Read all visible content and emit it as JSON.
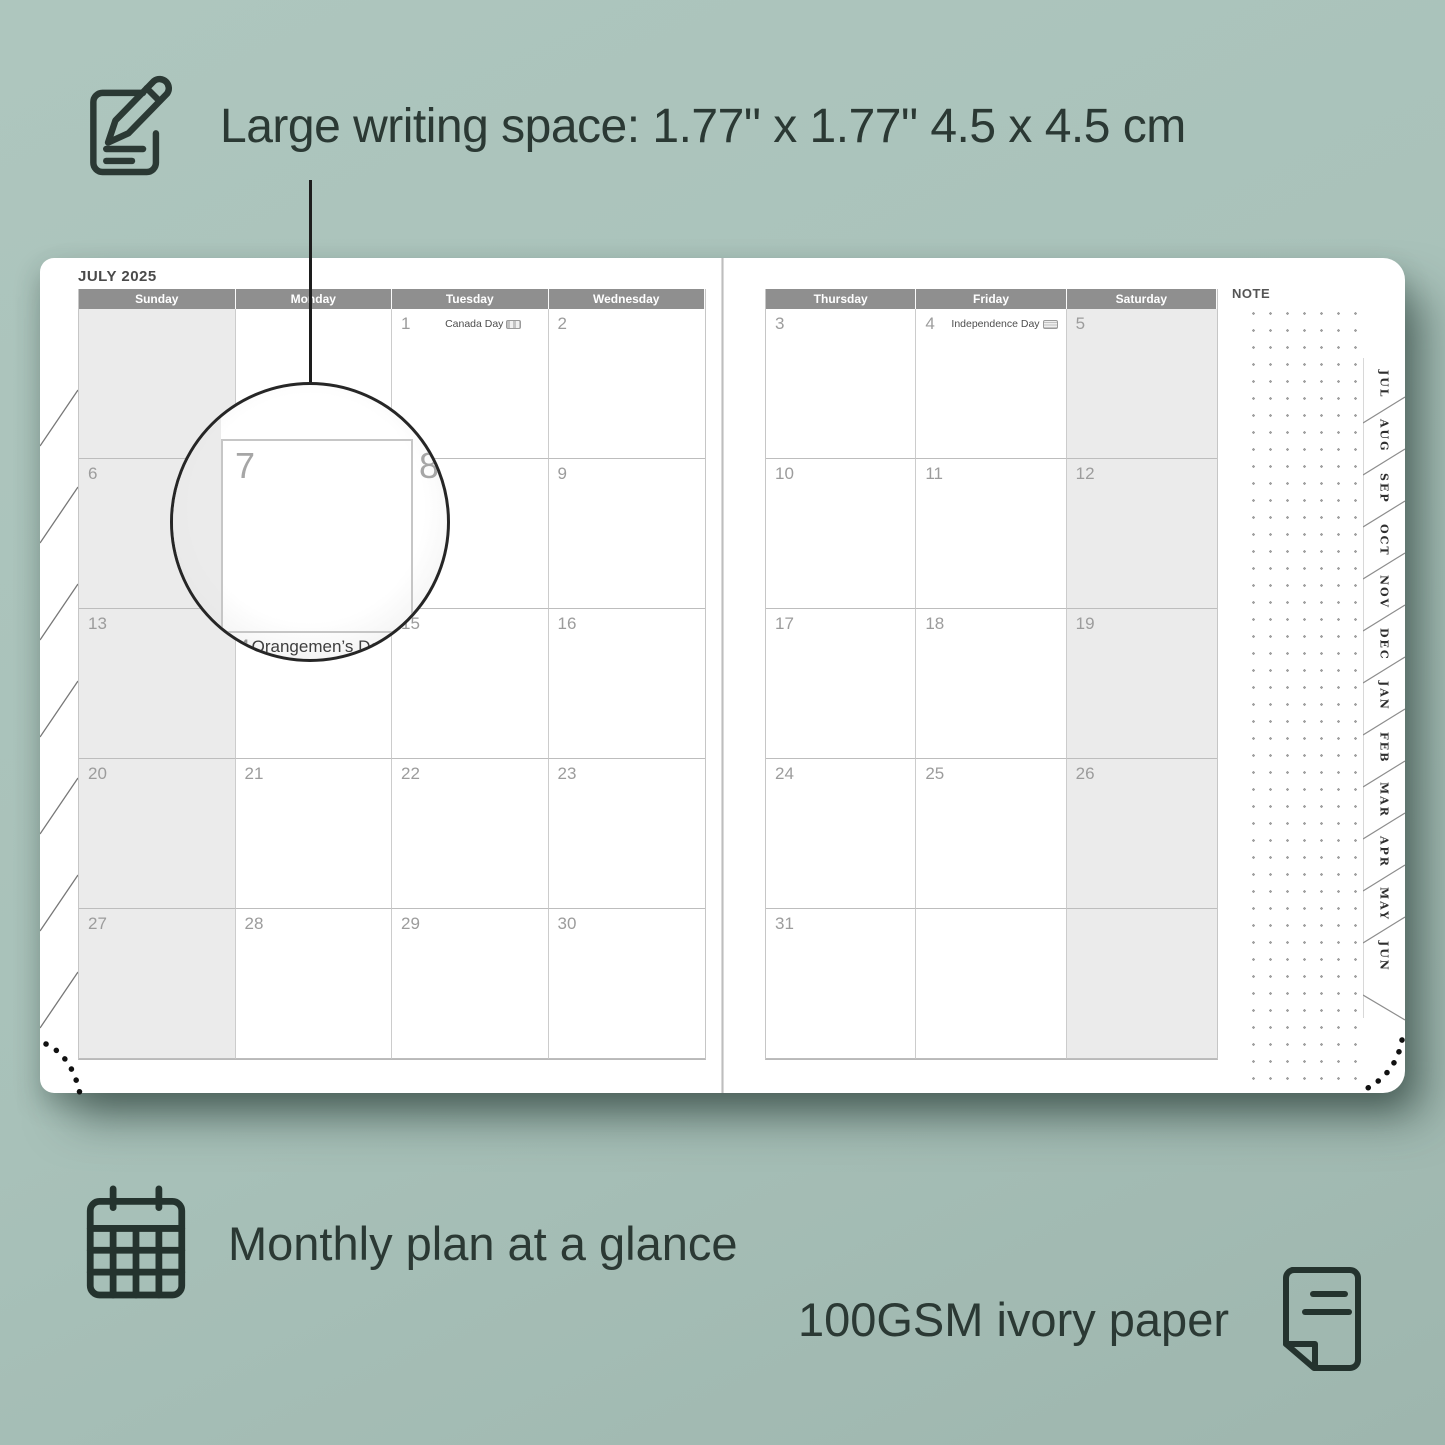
{
  "colors": {
    "background": "#a9c2ba",
    "ink": "#2b3934",
    "header_bar": "#8f8f8f",
    "shaded_cell": "#ebebeb",
    "grid_line": "#c6c6c6",
    "day_number": "#9c9c9c"
  },
  "annotations": {
    "top_feature": "Large writing space: 1.77\" x 1.77\" 4.5 x 4.5 cm",
    "monthly_feature": "Monthly plan at a glance",
    "paper_feature": "100GSM ivory paper"
  },
  "planner": {
    "month_title": "JULY 2025",
    "note_label": "NOTE",
    "left_day_headers": [
      "Sunday",
      "Monday",
      "Tuesday",
      "Wednesday"
    ],
    "right_day_headers": [
      "Thursday",
      "Friday",
      "Saturday"
    ],
    "month_tabs": [
      "JUL",
      "AUG",
      "SEP",
      "OCT",
      "NOV",
      "DEC",
      "JAN",
      "FEB",
      "MAR",
      "APR",
      "MAY",
      "JUN"
    ],
    "left_weeks": [
      [
        {
          "day": ""
        },
        {
          "day": ""
        },
        {
          "day": "1",
          "holiday": "Canada Day",
          "badge": "CA"
        },
        {
          "day": "2"
        }
      ],
      [
        {
          "day": "6"
        },
        {
          "day": "7"
        },
        {
          "day": "8"
        },
        {
          "day": "9"
        }
      ],
      [
        {
          "day": "13"
        },
        {
          "day": "14",
          "holiday": "Orangemen’s Day (N.L.)",
          "badge": "CA"
        },
        {
          "day": "15"
        },
        {
          "day": "16"
        }
      ],
      [
        {
          "day": "20"
        },
        {
          "day": "21"
        },
        {
          "day": "22"
        },
        {
          "day": "23"
        }
      ],
      [
        {
          "day": "27"
        },
        {
          "day": "28"
        },
        {
          "day": "29"
        },
        {
          "day": "30"
        }
      ]
    ],
    "right_weeks": [
      [
        {
          "day": "3"
        },
        {
          "day": "4",
          "holiday": "Independence Day",
          "badge": "US"
        },
        {
          "day": "5"
        }
      ],
      [
        {
          "day": "10"
        },
        {
          "day": "11"
        },
        {
          "day": "12"
        }
      ],
      [
        {
          "day": "17"
        },
        {
          "day": "18"
        },
        {
          "day": "19"
        }
      ],
      [
        {
          "day": "24"
        },
        {
          "day": "25"
        },
        {
          "day": "26"
        }
      ],
      [
        {
          "day": "31"
        },
        {
          "day": ""
        },
        {
          "day": ""
        }
      ]
    ],
    "shaded_left_col": 0,
    "shaded_right_col": 2
  },
  "magnifier": {
    "day": "7",
    "adjacent_day": "8",
    "partial_day": "4",
    "holiday_line1": "Orangemen’s Day",
    "holiday_line2": "(N.L.)"
  }
}
